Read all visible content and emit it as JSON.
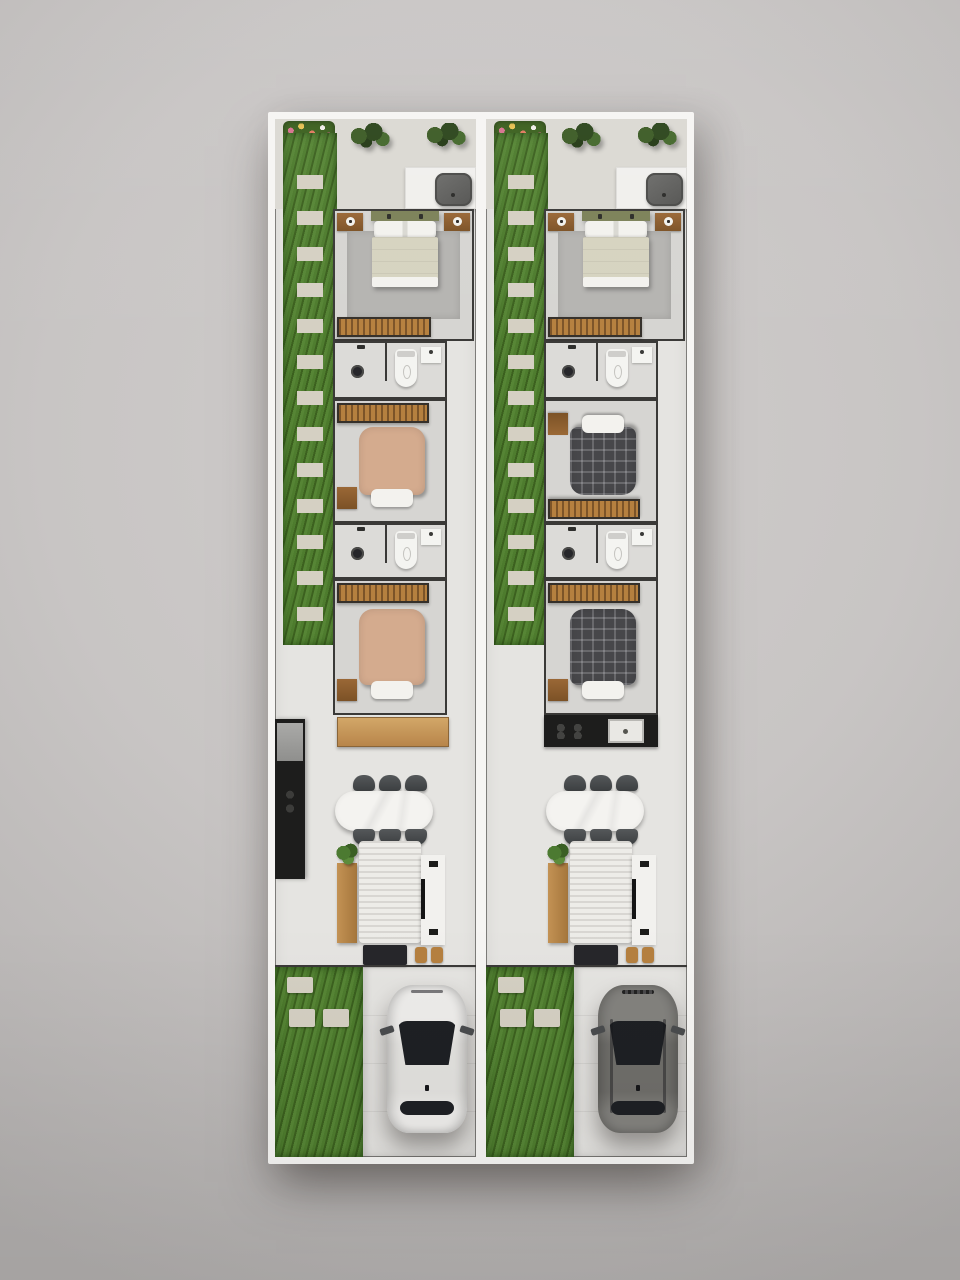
{
  "scene": {
    "description": "Top-down 3D architectural floor plan render of two identical narrow single-story townhouse units side by side, no visible text labels",
    "type": "floor-plan-3d-render"
  },
  "palette": {
    "backdrop": "#d0cdcc",
    "backdrop_edge": "#b2afae",
    "outer_wall": "#f6f5f3",
    "inner_wall": "#3a3937",
    "floor": "#e5e4e1",
    "floor_patio": "#dbd9d3",
    "floor_bedroom": "#d6d5d2",
    "floor_bath": "#dcdbd8",
    "rug_gray": "#b5b4b1",
    "grass": "#4e7c2e",
    "grass_dark": "#3c611f",
    "grass_light": "#568535",
    "paver": "#d5d0c3",
    "concrete": "#dbd8d3",
    "wood": "#b5803f",
    "wood_dark": "#7c5428",
    "wood_frame": "#35302a",
    "counter_black": "#1d1d1c",
    "appliance_gray": "#6e6e6c",
    "bed_master_blanket": "#d6d3c0",
    "bed_master_headboard": "#7c8158",
    "bed_tan": "#d4ab8e",
    "bed_plaid": "#47474a",
    "pillow_white": "#f3f2ee",
    "chair_dark": "#3c3f41",
    "table_white": "#f4f3f0",
    "sofa_white": "#edece8",
    "plant_green": "#4c7a31",
    "car_white": "#eeedeb",
    "car_white_roof": "#e3e2df",
    "car_gray": "#83827e",
    "car_gray_roof": "#6f6e6a",
    "car_glass": "#1e2024"
  },
  "units": [
    {
      "name": "unit-a",
      "side": "left",
      "car": "white-hatchback",
      "single_bed_finish": "tan",
      "kitchen_layout": "counter-on-left-wall-with-fridge"
    },
    {
      "name": "unit-b",
      "side": "right",
      "car": "gray-suv",
      "single_bed_finish": "dark-plaid",
      "kitchen_layout": "black-counter-with-sink-below-bedroom-3"
    }
  ],
  "rooms_per_unit": [
    "back-patio",
    "side-garden-path",
    "master-bedroom",
    "bathroom-1",
    "bedroom-2",
    "bathroom-2",
    "bedroom-3",
    "kitchen",
    "dining-area",
    "living-area",
    "front-lawn",
    "driveway"
  ],
  "furniture": {
    "back_patio": [
      "flower-bed",
      "shrubs",
      "laundry-counter",
      "laundry-tub"
    ],
    "master_bedroom": [
      "double-bed",
      "two-nightstands-with-lamps",
      "gray-area-rug",
      "slatted-wardrobe"
    ],
    "bathrooms": [
      "shower-with-round-drain",
      "toilet",
      "wall-sink"
    ],
    "bedrooms_2_3": [
      "slatted-wardrobe",
      "single-bed",
      "white-pillow",
      "wood-nightstand"
    ],
    "dining_area": [
      "white-oval-table",
      "six-dark-chairs"
    ],
    "living_area": [
      "wood-console",
      "potted-plant",
      "white-knit-rug",
      "tv-panel-with-tv",
      "entry-step",
      "two-stools"
    ],
    "front_yard": [
      "lawn-with-stepping-stones",
      "concrete-driveway",
      "parked-car"
    ]
  }
}
